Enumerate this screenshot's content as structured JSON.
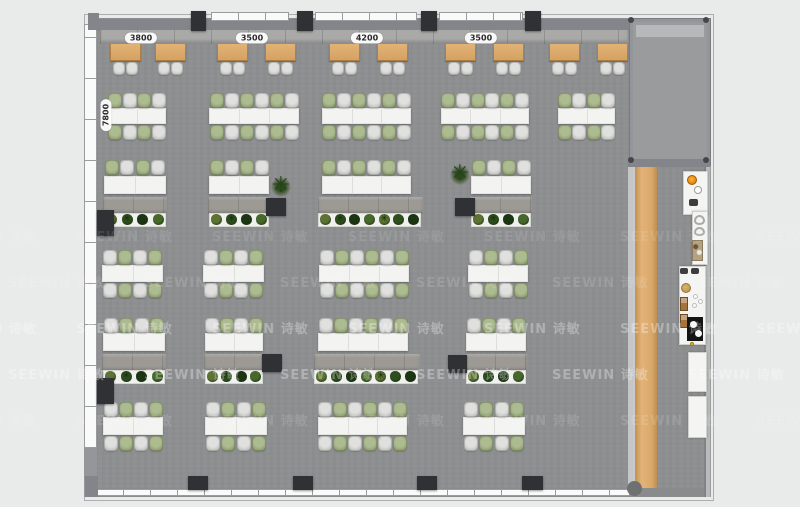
{
  "watermark": {
    "text": "SEEWIN 诗敏"
  },
  "icons": {
    "plant_star": "✳",
    "tree_symbol": "✳",
    "speaker_icon": "◢"
  },
  "colors": {
    "page_bg": "#e9eaea",
    "floor": "#8e8f91",
    "wall": "#84858a",
    "wood": "#d9a96a",
    "table": "#f3f3f2",
    "chair_green": "#8a9a6e",
    "chair_gray": "#bfbfbd",
    "plant_green": "#2e4e1e",
    "column": "#303134",
    "burner_orange": "#df860a"
  },
  "dimensions": {
    "top": [
      {
        "label": "3800",
        "x": 141,
        "y": 38
      },
      {
        "label": "3500",
        "x": 252,
        "y": 38
      },
      {
        "label": "4200",
        "x": 367,
        "y": 38
      },
      {
        "label": "3500",
        "x": 481,
        "y": 38
      }
    ],
    "left": [
      {
        "label": "7800",
        "x": 106,
        "y": 115
      }
    ]
  },
  "floorplan": {
    "frame": [
      84,
      14,
      630,
      487
    ],
    "floor": [
      88,
      18,
      622,
      479
    ],
    "top_wall": [
      88,
      19,
      622,
      12
    ],
    "top_windows": [
      [
        211,
        12,
        78,
        9
      ],
      [
        315,
        12,
        102,
        9
      ],
      [
        439,
        12,
        84,
        9
      ]
    ],
    "top_columns": [
      [
        191,
        11,
        15,
        20
      ],
      [
        297,
        11,
        16,
        20
      ],
      [
        421,
        11,
        16,
        20
      ],
      [
        525,
        11,
        16,
        20
      ]
    ],
    "bottom_wall": [
      88,
      488,
      622,
      9
    ],
    "bottom_window": [
      96,
      489,
      534,
      7
    ],
    "bottom_columns": [
      [
        188,
        476,
        20,
        14
      ],
      [
        293,
        476,
        20,
        14
      ],
      [
        417,
        476,
        20,
        14
      ],
      [
        522,
        476,
        21,
        14
      ]
    ],
    "left_window": [
      84,
      24,
      13,
      424
    ],
    "left_solid": [
      84,
      448,
      13,
      49
    ],
    "left_columns": [
      [
        97,
        210,
        17,
        26
      ],
      [
        97,
        378,
        17,
        26
      ]
    ],
    "floor_columns": [
      [
        266,
        198,
        20,
        18
      ],
      [
        455,
        198,
        20,
        18
      ],
      [
        262,
        354,
        20,
        18
      ],
      [
        448,
        355,
        19,
        18
      ]
    ],
    "right_wall": [
      704,
      18,
      7,
      479
    ],
    "room": [
      630,
      19,
      80,
      146
    ],
    "room_top_strip": [
      636,
      25,
      68,
      12
    ],
    "room_bottom_wall": [
      628,
      159,
      82,
      8
    ],
    "room_dots": [
      [
        628,
        17
      ],
      [
        703,
        17
      ],
      [
        628,
        157
      ],
      [
        703,
        157
      ]
    ],
    "divider": [
      628,
      167,
      5,
      323
    ],
    "wood_counter": [
      633,
      167,
      24,
      321
    ],
    "corner_posts": [
      [
        88,
        13,
        11,
        17
      ],
      [
        85,
        476,
        13,
        21
      ]
    ],
    "bottom_right_circle": [
      627,
      481,
      15,
      15
    ],
    "banquette": [
      100,
      30,
      528,
      14
    ],
    "wood_tables": {
      "xs": [
        110,
        155,
        217,
        265,
        329,
        377,
        445,
        493,
        549,
        597
      ],
      "y": 43,
      "w": 31,
      "h": 18,
      "chair_y": 62,
      "chair_w": 12,
      "chair_h": 13
    },
    "rows": [
      {
        "chair_top": 93,
        "table_y": 108,
        "table_h": 16,
        "chair_bottom": 125,
        "start": "green",
        "groups": [
          {
            "x": 108,
            "w": 58,
            "s": 4
          },
          {
            "x": 209,
            "w": 90,
            "s": 6
          },
          {
            "x": 322,
            "w": 89,
            "s": 6
          },
          {
            "x": 441,
            "w": 88,
            "s": 6
          },
          {
            "x": 558,
            "w": 57,
            "s": 4
          }
        ]
      },
      {
        "chair_top": 160,
        "table_y": 176,
        "table_h": 18,
        "bench_y": 197,
        "planter_y": 213,
        "start": "green",
        "groups": [
          {
            "x": 104,
            "w": 62,
            "s": 4
          },
          {
            "x": 209,
            "w": 60,
            "s": 4
          },
          {
            "x": 322,
            "w": 89,
            "s": 6
          },
          {
            "x": 471,
            "w": 60,
            "s": 4
          }
        ]
      },
      {
        "chair_top": 250,
        "table_y": 265,
        "table_h": 17,
        "chair_bottom": 283,
        "start": "gray",
        "groups": [
          {
            "x": 102,
            "w": 61,
            "s": 4
          },
          {
            "x": 203,
            "w": 61,
            "s": 4
          },
          {
            "x": 319,
            "w": 90,
            "s": 6
          },
          {
            "x": 468,
            "w": 60,
            "s": 4
          }
        ]
      },
      {
        "chair_top": 318,
        "table_y": 333,
        "table_h": 18,
        "bench_y": 354,
        "planter_y": 370,
        "start": "gray",
        "groups": [
          {
            "x": 103,
            "w": 62,
            "s": 4
          },
          {
            "x": 205,
            "w": 58,
            "s": 4
          },
          {
            "x": 318,
            "w": 90,
            "s": 6
          },
          {
            "x": 466,
            "w": 60,
            "s": 4
          }
        ]
      },
      {
        "chair_top": 402,
        "table_y": 417,
        "table_h": 18,
        "chair_bottom": 436,
        "start": "gray",
        "groups": [
          {
            "x": 103,
            "w": 60,
            "s": 4
          },
          {
            "x": 205,
            "w": 62,
            "s": 4
          },
          {
            "x": 318,
            "w": 89,
            "s": 6
          },
          {
            "x": 463,
            "w": 62,
            "s": 4
          }
        ]
      }
    ],
    "trees": [
      {
        "x": 271,
        "y": 177
      },
      {
        "x": 450,
        "y": 165
      }
    ],
    "plant_colors": [
      "#5c7334",
      "#2e4e1e",
      "#1c3513",
      "#46682a"
    ],
    "kitchen": {
      "counters": [
        [
          683,
          171,
          25,
          44
        ],
        [
          692,
          211,
          16,
          54
        ],
        [
          679,
          266,
          27,
          79
        ],
        [
          688,
          352,
          19,
          40
        ],
        [
          688,
          396,
          19,
          42
        ]
      ],
      "items": [
        {
          "t": "orange",
          "n": "stove-burner",
          "x": 687,
          "y": 175,
          "w": 10,
          "h": 10
        },
        {
          "t": "ring",
          "n": "hob-ring",
          "x": 694,
          "y": 186,
          "w": 8,
          "h": 8
        },
        {
          "t": "dark",
          "n": "speaker-icon",
          "x": 689,
          "y": 199,
          "w": 9,
          "h": 7
        },
        {
          "t": "sink",
          "n": "sink-basin",
          "x": 694,
          "y": 215,
          "w": 11,
          "h": 10
        },
        {
          "t": "sink",
          "n": "sink-basin",
          "x": 694,
          "y": 227,
          "w": 11,
          "h": 9
        },
        {
          "t": "equip",
          "n": "coffee-machine",
          "x": 692,
          "y": 240,
          "w": 11,
          "h": 21
        },
        {
          "t": "dark",
          "n": "vent-fan",
          "x": 680,
          "y": 268,
          "w": 8,
          "h": 6
        },
        {
          "t": "dark",
          "n": "vent-fan",
          "x": 691,
          "y": 268,
          "w": 8,
          "h": 6
        },
        {
          "t": "tan",
          "n": "round-hotplate",
          "x": 681,
          "y": 283,
          "w": 10,
          "h": 10
        },
        {
          "t": "white",
          "n": "small-dish",
          "x": 693,
          "y": 294,
          "w": 5,
          "h": 5
        },
        {
          "t": "white",
          "n": "small-dish",
          "x": 698,
          "y": 299,
          "w": 5,
          "h": 5
        },
        {
          "t": "white",
          "n": "small-dish",
          "x": 692,
          "y": 303,
          "w": 5,
          "h": 5
        },
        {
          "t": "brown",
          "n": "appliance-box",
          "x": 680,
          "y": 297,
          "w": 8,
          "h": 14
        },
        {
          "t": "brown",
          "n": "appliance-box",
          "x": 680,
          "y": 314,
          "w": 8,
          "h": 14
        },
        {
          "t": "black",
          "n": "range-top",
          "x": 687,
          "y": 317,
          "w": 16,
          "h": 24
        },
        {
          "t": "blackdot",
          "n": "pot",
          "x": 690,
          "y": 321,
          "w": 7,
          "h": 7
        },
        {
          "t": "blackdot",
          "n": "pot",
          "x": 695,
          "y": 330,
          "w": 7,
          "h": 7
        },
        {
          "t": "yellow",
          "n": "warning-dot",
          "x": 690,
          "y": 342,
          "w": 4,
          "h": 4
        }
      ]
    },
    "watermark_rows": [
      {
        "y": 226,
        "opacity": 0.1,
        "offset": 0
      },
      {
        "y": 272,
        "opacity": 0.13,
        "offset": 68
      },
      {
        "y": 318,
        "opacity": 0.3,
        "offset": 0
      },
      {
        "y": 364,
        "opacity": 0.3,
        "offset": 68
      },
      {
        "y": 410,
        "opacity": 0.12,
        "offset": 0
      }
    ]
  }
}
